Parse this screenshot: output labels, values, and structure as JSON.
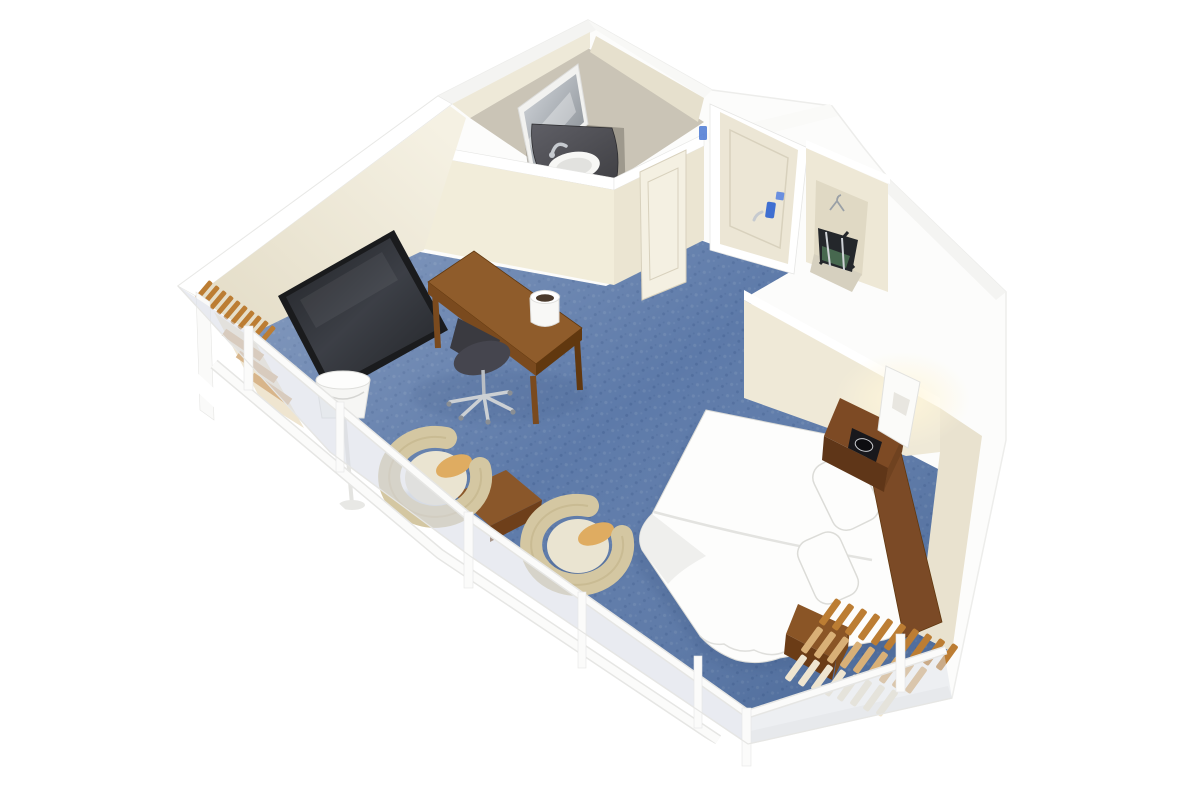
{
  "meta": {
    "title": "3D isometric cutaway rendering of a hotel guest room floor plan"
  },
  "labels": {
    "scene": "hotel guest room 3d floor plan",
    "shell": "white exterior walls",
    "carpet": "blue carpet floor",
    "bathroom": "bathroom",
    "bath_floor": "bathroom tile floor",
    "mirror": "leaning vanity mirror",
    "vanity": "dark vanity counter with sink",
    "sink": "white oval sink",
    "faucet": "chrome faucet",
    "towel_ring": "towel ring",
    "pocket_door": "bathroom sliding door",
    "entry_door": "entry door with key lock",
    "door_hardware": "blue door lock hardware",
    "closet": "closet alcove",
    "luggage_rack": "folding luggage rack with bag",
    "hanger": "clothes hanger",
    "tv": "wall mounted flat screen tv",
    "desk": "wooden work desk",
    "desk_chair": "rolling office chair",
    "ice_bucket": "ice bucket on desk",
    "bed": "bed with white bedding",
    "pillow": "pillow",
    "headboard": "wooden headboard panel",
    "nightstand": "wooden nightstand",
    "clock": "black alarm clock",
    "sconce": "white wall sconce lamp",
    "bench": "wooden luggage bench at bed foot",
    "chair_left": "tan tub chair",
    "chair_right": "tan tub chair",
    "side_table": "small wooden side table",
    "floor_lamp": "white drum floor lamp",
    "window_wall": "glass window wall with white mullions",
    "heater_left": "heating unit with brown fins, left corner",
    "heater_right": "heating unit with brown fins, right corner"
  },
  "palette": {
    "bg": "#ffffff",
    "shellFill": "#fcfcfb",
    "shellEdge": "#ededeb",
    "shellShade": "#f4f4f2",
    "wallTop": "#ffffff",
    "cream": "#f0ebdb",
    "creamLight": "#f5f1e3",
    "creamShade": "#e4ddc8",
    "creamDark": "#d9d2bc",
    "bathFloor": "#cac4b6",
    "bathFloorDark": "#716d64",
    "vanityTop": "#3f3f43",
    "vanityHi": "#5f5f66",
    "sink": "#f7f7f5",
    "sinkInner": "#e2e2df",
    "mirrorHi": "#d3d7dc",
    "mirrorLo": "#83898f",
    "carpetBase": "#5d7aa9",
    "carpetLight": "#6f8ab3",
    "carpetDark": "#4d6b9b",
    "glassTint": "#c7cfdd",
    "railWhite": "#fbfbfa",
    "railEdge": "#e6e6e4",
    "doorSlab": "#ece6d5",
    "doorLine": "#d8d1bd",
    "blueHw": "#3f6fd1",
    "blueHwLight": "#6a8fdf",
    "woodTop": "#8f5c2b",
    "woodMid": "#7a4a1e",
    "woodDark": "#61380f",
    "headboard": "#7b4a26",
    "nightstand": "#6f4220",
    "tvFrame": "#1a1b1d",
    "tvHi": "#3c3f46",
    "tvLo": "#222428",
    "bedding": "#fdfdfc",
    "beddingShade": "#ebebe8",
    "beddingEdge": "#dcdcd8",
    "chairShell": "#d4c7a2",
    "chairShellDark": "#c2b389",
    "chairSeat": "#eae4d1",
    "cushion": "#dfac61",
    "finBrown": "#bc7d33",
    "finTan": "#d9b077",
    "finCream": "#efe5d0",
    "clockDark": "#18181c",
    "chrome": "#c6cacf",
    "shadowBlue": "#34507c",
    "glow": "#fff6da",
    "closetBack": "#e0d9c4",
    "closetFloor": "#d6d0bf",
    "rackDark": "#24272b",
    "rackGreen": "#47684f"
  }
}
